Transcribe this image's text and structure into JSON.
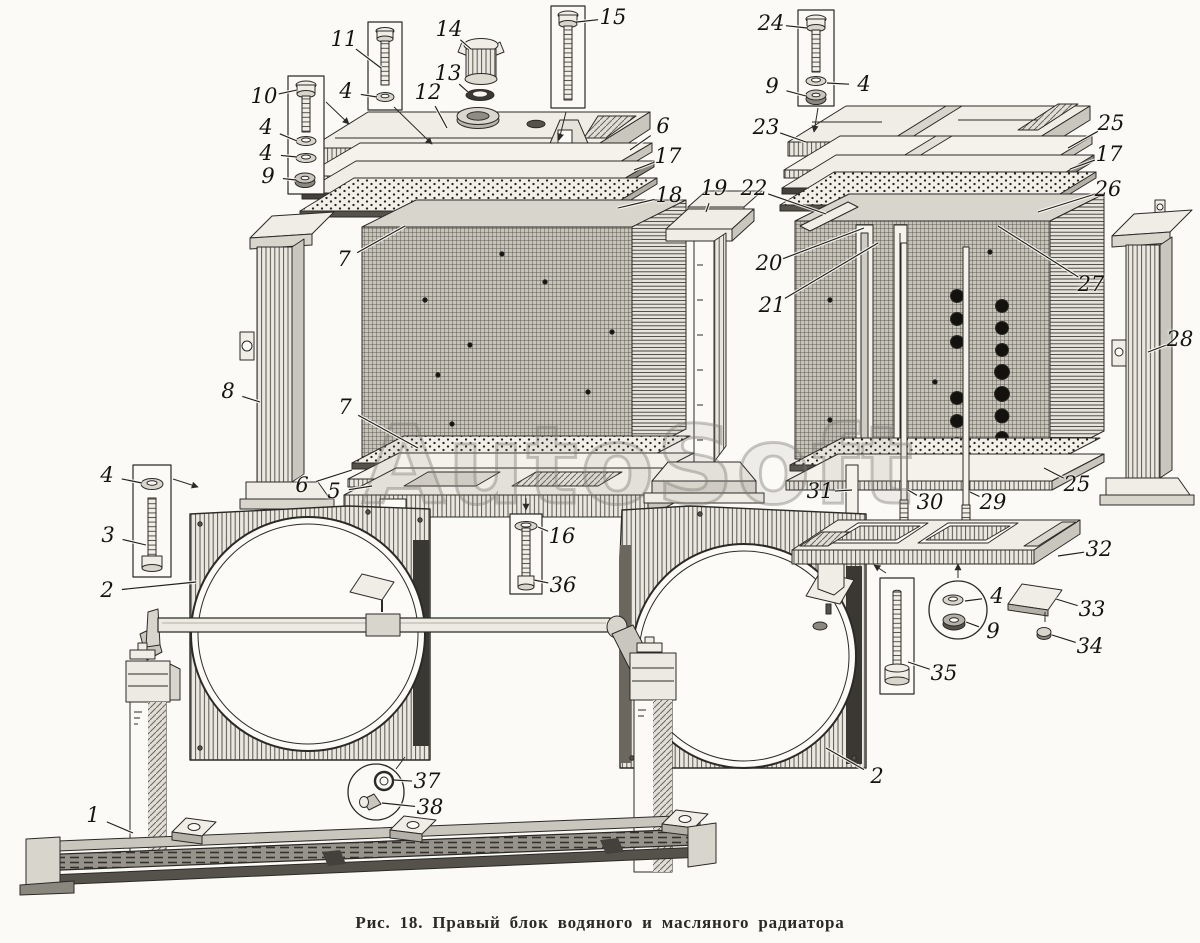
{
  "figure": {
    "caption": "Рис. 18. Правый блок водяного и масляного радиатора",
    "watermark": "AutoSoft",
    "ink_color": "#2b2a26",
    "paper_color": "#fbfaf6"
  },
  "part_labels": [
    {
      "t": "11",
      "x": 344,
      "y": 40,
      "tx": 381,
      "ty": 68
    },
    {
      "t": "4",
      "x": 346,
      "y": 92,
      "tx": 377,
      "ty": 97
    },
    {
      "t": "10",
      "x": 264,
      "y": 97,
      "tx": 297,
      "ty": 90
    },
    {
      "t": "4",
      "x": 266,
      "y": 128,
      "tx": 297,
      "ty": 141
    },
    {
      "t": "4",
      "x": 266,
      "y": 154,
      "tx": 297,
      "ty": 157
    },
    {
      "t": "9",
      "x": 268,
      "y": 177,
      "tx": 296,
      "ty": 180
    },
    {
      "t": "14",
      "x": 449,
      "y": 30,
      "tx": 471,
      "ty": 49
    },
    {
      "t": "13",
      "x": 448,
      "y": 74,
      "tx": 468,
      "ty": 92
    },
    {
      "t": "15",
      "x": 613,
      "y": 18,
      "tx": 577,
      "ty": 22
    },
    {
      "t": "12",
      "x": 428,
      "y": 93,
      "tx": 447,
      "ty": 128
    },
    {
      "t": "6",
      "x": 663,
      "y": 127,
      "tx": 630,
      "ty": 150
    },
    {
      "t": "17",
      "x": 668,
      "y": 157,
      "tx": 634,
      "ty": 170
    },
    {
      "t": "18",
      "x": 669,
      "y": 196,
      "tx": 618,
      "ty": 208
    },
    {
      "t": "7",
      "x": 344,
      "y": 260,
      "tx": 405,
      "ty": 226
    },
    {
      "t": "8",
      "x": 228,
      "y": 392,
      "tx": 260,
      "ty": 402
    },
    {
      "t": "7",
      "x": 345,
      "y": 408,
      "tx": 418,
      "ty": 448
    },
    {
      "t": "6",
      "x": 302,
      "y": 486,
      "tx": 352,
      "ty": 470
    },
    {
      "t": "5",
      "x": 334,
      "y": 492,
      "tx": 372,
      "ty": 486
    },
    {
      "t": "19",
      "x": 714,
      "y": 189,
      "tx": 706,
      "ty": 212
    },
    {
      "t": "22",
      "x": 754,
      "y": 189,
      "tx": 826,
      "ty": 214
    },
    {
      "t": "20",
      "x": 769,
      "y": 264,
      "tx": 864,
      "ty": 228
    },
    {
      "t": "21",
      "x": 772,
      "y": 306,
      "tx": 878,
      "ty": 243
    },
    {
      "t": "24",
      "x": 771,
      "y": 24,
      "tx": 807,
      "ty": 28
    },
    {
      "t": "9",
      "x": 772,
      "y": 87,
      "tx": 806,
      "ty": 96
    },
    {
      "t": "4",
      "x": 864,
      "y": 85,
      "tx": 827,
      "ty": 83
    },
    {
      "t": "23",
      "x": 766,
      "y": 128,
      "tx": 806,
      "ty": 142
    },
    {
      "t": "25",
      "x": 1111,
      "y": 124,
      "tx": 1068,
      "ty": 148
    },
    {
      "t": "17",
      "x": 1109,
      "y": 155,
      "tx": 1070,
      "ty": 169
    },
    {
      "t": "26",
      "x": 1108,
      "y": 190,
      "tx": 1038,
      "ty": 212
    },
    {
      "t": "27",
      "x": 1091,
      "y": 285,
      "tx": 998,
      "ty": 226
    },
    {
      "t": "28",
      "x": 1180,
      "y": 340,
      "tx": 1148,
      "ty": 352
    },
    {
      "t": "25",
      "x": 1077,
      "y": 485,
      "tx": 1044,
      "ty": 468
    },
    {
      "t": "31",
      "x": 820,
      "y": 492,
      "tx": 852,
      "ty": 490
    },
    {
      "t": "30",
      "x": 930,
      "y": 503,
      "tx": 908,
      "ty": 490
    },
    {
      "t": "29",
      "x": 993,
      "y": 503,
      "tx": 970,
      "ty": 492
    },
    {
      "t": "32",
      "x": 1099,
      "y": 550,
      "tx": 1058,
      "ty": 556
    },
    {
      "t": "4",
      "x": 997,
      "y": 597,
      "tx": 965,
      "ty": 601
    },
    {
      "t": "9",
      "x": 993,
      "y": 632,
      "tx": 966,
      "ty": 622
    },
    {
      "t": "33",
      "x": 1092,
      "y": 610,
      "tx": 1056,
      "ty": 599
    },
    {
      "t": "34",
      "x": 1090,
      "y": 647,
      "tx": 1052,
      "ty": 635
    },
    {
      "t": "35",
      "x": 944,
      "y": 674,
      "tx": 908,
      "ty": 662
    },
    {
      "t": "16",
      "x": 562,
      "y": 537,
      "tx": 538,
      "ty": 527
    },
    {
      "t": "36",
      "x": 563,
      "y": 586,
      "tx": 534,
      "ty": 580
    },
    {
      "t": "4",
      "x": 107,
      "y": 476,
      "tx": 142,
      "ty": 483
    },
    {
      "t": "3",
      "x": 108,
      "y": 536,
      "tx": 146,
      "ty": 545
    },
    {
      "t": "2",
      "x": 107,
      "y": 591,
      "tx": 196,
      "ty": 582
    },
    {
      "t": "2",
      "x": 877,
      "y": 777,
      "tx": 826,
      "ty": 748
    },
    {
      "t": "1",
      "x": 93,
      "y": 816,
      "tx": 133,
      "ty": 833
    },
    {
      "t": "37",
      "x": 427,
      "y": 782,
      "tx": 394,
      "ty": 780
    },
    {
      "t": "38",
      "x": 430,
      "y": 808,
      "tx": 382,
      "ty": 803
    }
  ]
}
